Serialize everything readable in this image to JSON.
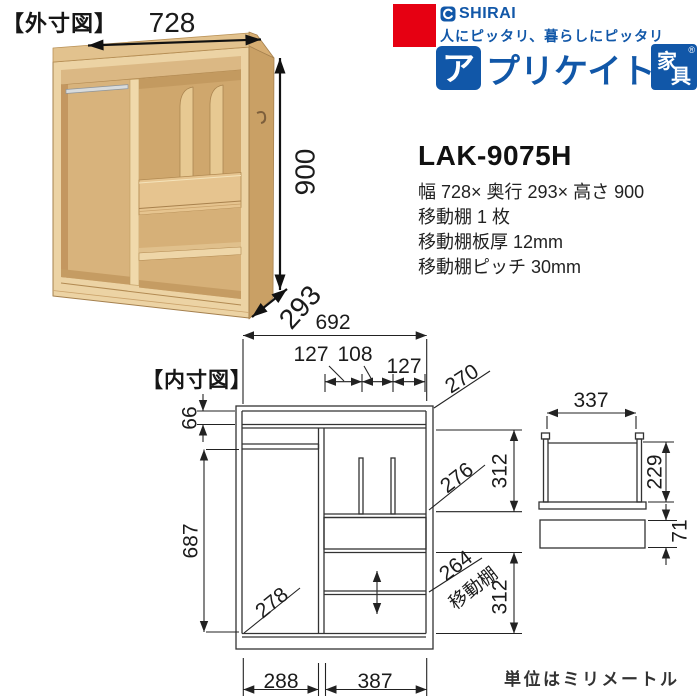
{
  "meta": {
    "unit_note": "単位はミリメートル"
  },
  "brand": {
    "shirai": "SHIRAI",
    "tagline": "人にピッタリ、暮らしにピッタリ",
    "series_first_char": "ア",
    "series_rest": "プリケイト",
    "category_top": "家",
    "category_bottom": "具",
    "reg_mark": "®",
    "brand_red": "#e60012",
    "brand_blue": "#1157a8"
  },
  "product": {
    "model": "LAK-9075H",
    "specs": [
      "幅 728× 奥行 293× 高さ 900",
      "移動棚 1 枚",
      "移動棚板厚 12mm",
      "移動棚ピッチ 30mm"
    ]
  },
  "external_diagram": {
    "label": "【外寸図】",
    "width": "728",
    "height": "900",
    "depth": "293"
  },
  "internal_diagram": {
    "label": "【内寸図】",
    "inner_width": "692",
    "seg_left": "127",
    "seg_mid": "108",
    "seg_right": "127",
    "top_depth": "270",
    "top_clearance": "66",
    "left_height": "687",
    "left_depth": "278",
    "upper_right_depth": "276",
    "upper_right_height": "312",
    "movable_shelf_width": "264",
    "movable_shelf_label": "移動棚",
    "lower_right_height": "312",
    "bottom_left_width": "288",
    "bottom_right_width": "387",
    "side_view_width": "337",
    "side_view_height": "229",
    "side_view_drawer_height": "71"
  }
}
